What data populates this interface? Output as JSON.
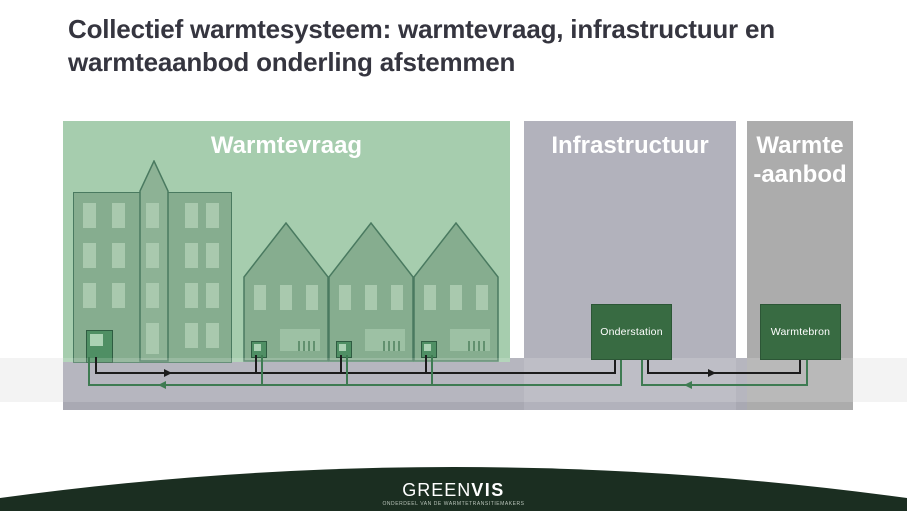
{
  "title": "Collectief warmtesysteem: warmtevraag, infrastructuur en warmteaanbod onderling afstemmen",
  "panels": {
    "warmtevraag": {
      "label": "Warmtevraag"
    },
    "infrastructuur": {
      "label": "Infrastructuur"
    },
    "warmteaanbod": {
      "line1": "Warmte",
      "line2": "-aanbod"
    }
  },
  "nodes": {
    "onderstation": {
      "label": "Onderstation"
    },
    "warmtebron": {
      "label": "Warmtebron"
    }
  },
  "footer": {
    "brand_green": "GREEN",
    "brand_vis": "VIS",
    "tagline": "ONDERDEEL VAN DE WARMTETRANSITIEMAKERS"
  },
  "colors": {
    "title_text": "#35353f",
    "panel_demand_green": "#a6cdae",
    "panel_infra_gray": "#b2b2bc",
    "panel_supply_gray": "#acacac",
    "building_fill": "#86ad8f",
    "building_outline": "#4a7a60",
    "window_fill": "#a9c9ae",
    "node_box_green": "#386b42",
    "pipe_supply_black": "#1c1c1c",
    "pipe_return_green": "#3e7b52",
    "ground_gray": "#a9a9b3",
    "ground_band_light": "#f1f1f1",
    "footer_dark_green": "#1b2e21"
  }
}
